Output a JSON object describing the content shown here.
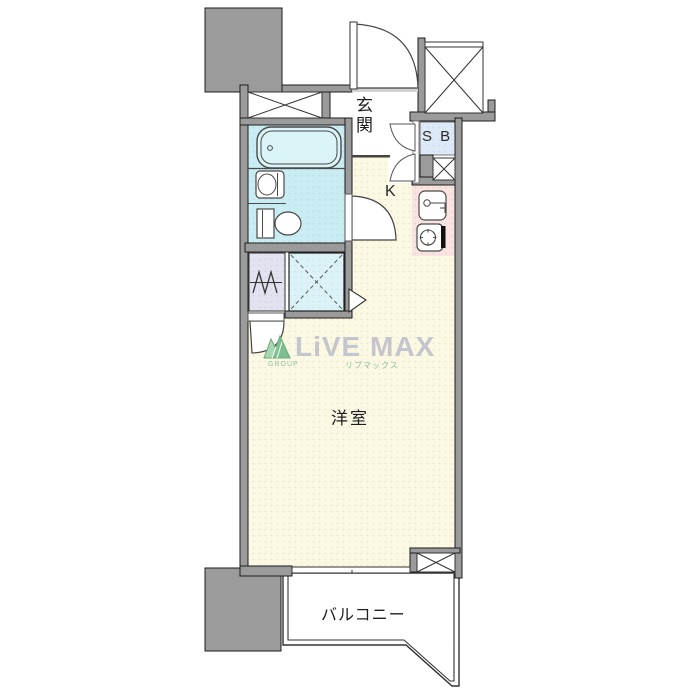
{
  "plan": {
    "rooms": {
      "entrance": "玄関",
      "shoe_box": "S B",
      "kitchen": "K",
      "western_room": "洋室",
      "balcony": "バルコニー"
    },
    "watermark": {
      "brand": "LiVE MAX",
      "group": "GROUP",
      "reading": "リブマックス"
    },
    "icons": {
      "bathtub": "bathtub-icon",
      "washbasin": "washbasin-icon",
      "toilet": "toilet-icon",
      "washing_machine": "washing-machine-icon",
      "kitchen_sink": "kitchen-sink-icon",
      "stove": "stove-icon",
      "closet_x": "closet-cross-icon",
      "elevator_x": "elevator-cross-icon"
    },
    "colors": {
      "wall_gray": "#9b9b9b",
      "floor_cream": "#fbf8e4",
      "bathroom_cyan": "#c9edf2",
      "shower_box_cyan": "#dbf2f7",
      "shoe_box_blue": "#dde9f6",
      "washer_lavender": "#e2e2f0",
      "kitchen_counter_pink": "#f9e4e0",
      "watermark_gray": "#c5c5cd",
      "watermark_green": "#8cc09a",
      "line_dark": "#333333"
    }
  }
}
